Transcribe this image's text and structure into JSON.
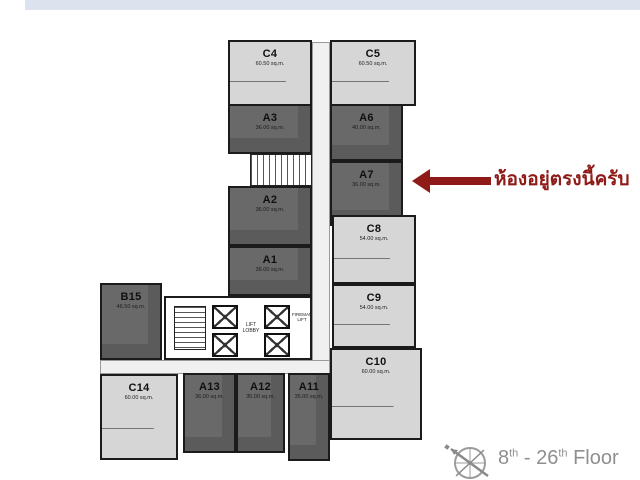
{
  "banner": {
    "color": "#dce3ee"
  },
  "plan": {
    "units": [
      {
        "id": "C4",
        "area": "60.50 sq.m.",
        "shade": "light"
      },
      {
        "id": "C5",
        "area": "60.50 sq.m.",
        "shade": "light"
      },
      {
        "id": "A3",
        "area": "36.00 sq.m.",
        "shade": "dark"
      },
      {
        "id": "A6",
        "area": "40.00 sq.m.",
        "shade": "dark"
      },
      {
        "id": "A2",
        "area": "36.00 sq.m.",
        "shade": "dark"
      },
      {
        "id": "A7",
        "area": "36.00 sq.m.",
        "shade": "dark",
        "highlighted": true
      },
      {
        "id": "A1",
        "area": "36.00 sq.m.",
        "shade": "dark"
      },
      {
        "id": "C8",
        "area": "54.00 sq.m.",
        "shade": "light"
      },
      {
        "id": "C9",
        "area": "54.00 sq.m.",
        "shade": "light"
      },
      {
        "id": "B15",
        "area": "46.50 sq.m.",
        "shade": "dark"
      },
      {
        "id": "C10",
        "area": "60.00 sq.m.",
        "shade": "light"
      },
      {
        "id": "C14",
        "area": "60.00 sq.m.",
        "shade": "light"
      },
      {
        "id": "A13",
        "area": "36.00 sq.m.",
        "shade": "dark"
      },
      {
        "id": "A12",
        "area": "35.00 sq.m.",
        "shade": "dark"
      },
      {
        "id": "A11",
        "area": "35.00 sq.m.",
        "shade": "dark"
      }
    ],
    "core": {
      "lift_lobby": "LIFT LOBBY",
      "fireman_lift": "FIREMAN LIFT"
    }
  },
  "annotation": {
    "text": "ห้องอยู่ตรงนี้ครับ",
    "target_unit": "A7",
    "color": "#8e1b17"
  },
  "footer": {
    "floor_from": "8",
    "floor_from_sup": "th",
    "floor_separator": " - ",
    "floor_to": "26",
    "floor_to_sup": "th",
    "floor_word": " Floor"
  },
  "colors": {
    "light_unit": "#d6d6d6",
    "dark_unit": "#696969",
    "wall": "#1b1b1b",
    "arrow": "#8e1b17",
    "footer_text": "#8f8f8f",
    "top_banner": "#dce3ee"
  }
}
